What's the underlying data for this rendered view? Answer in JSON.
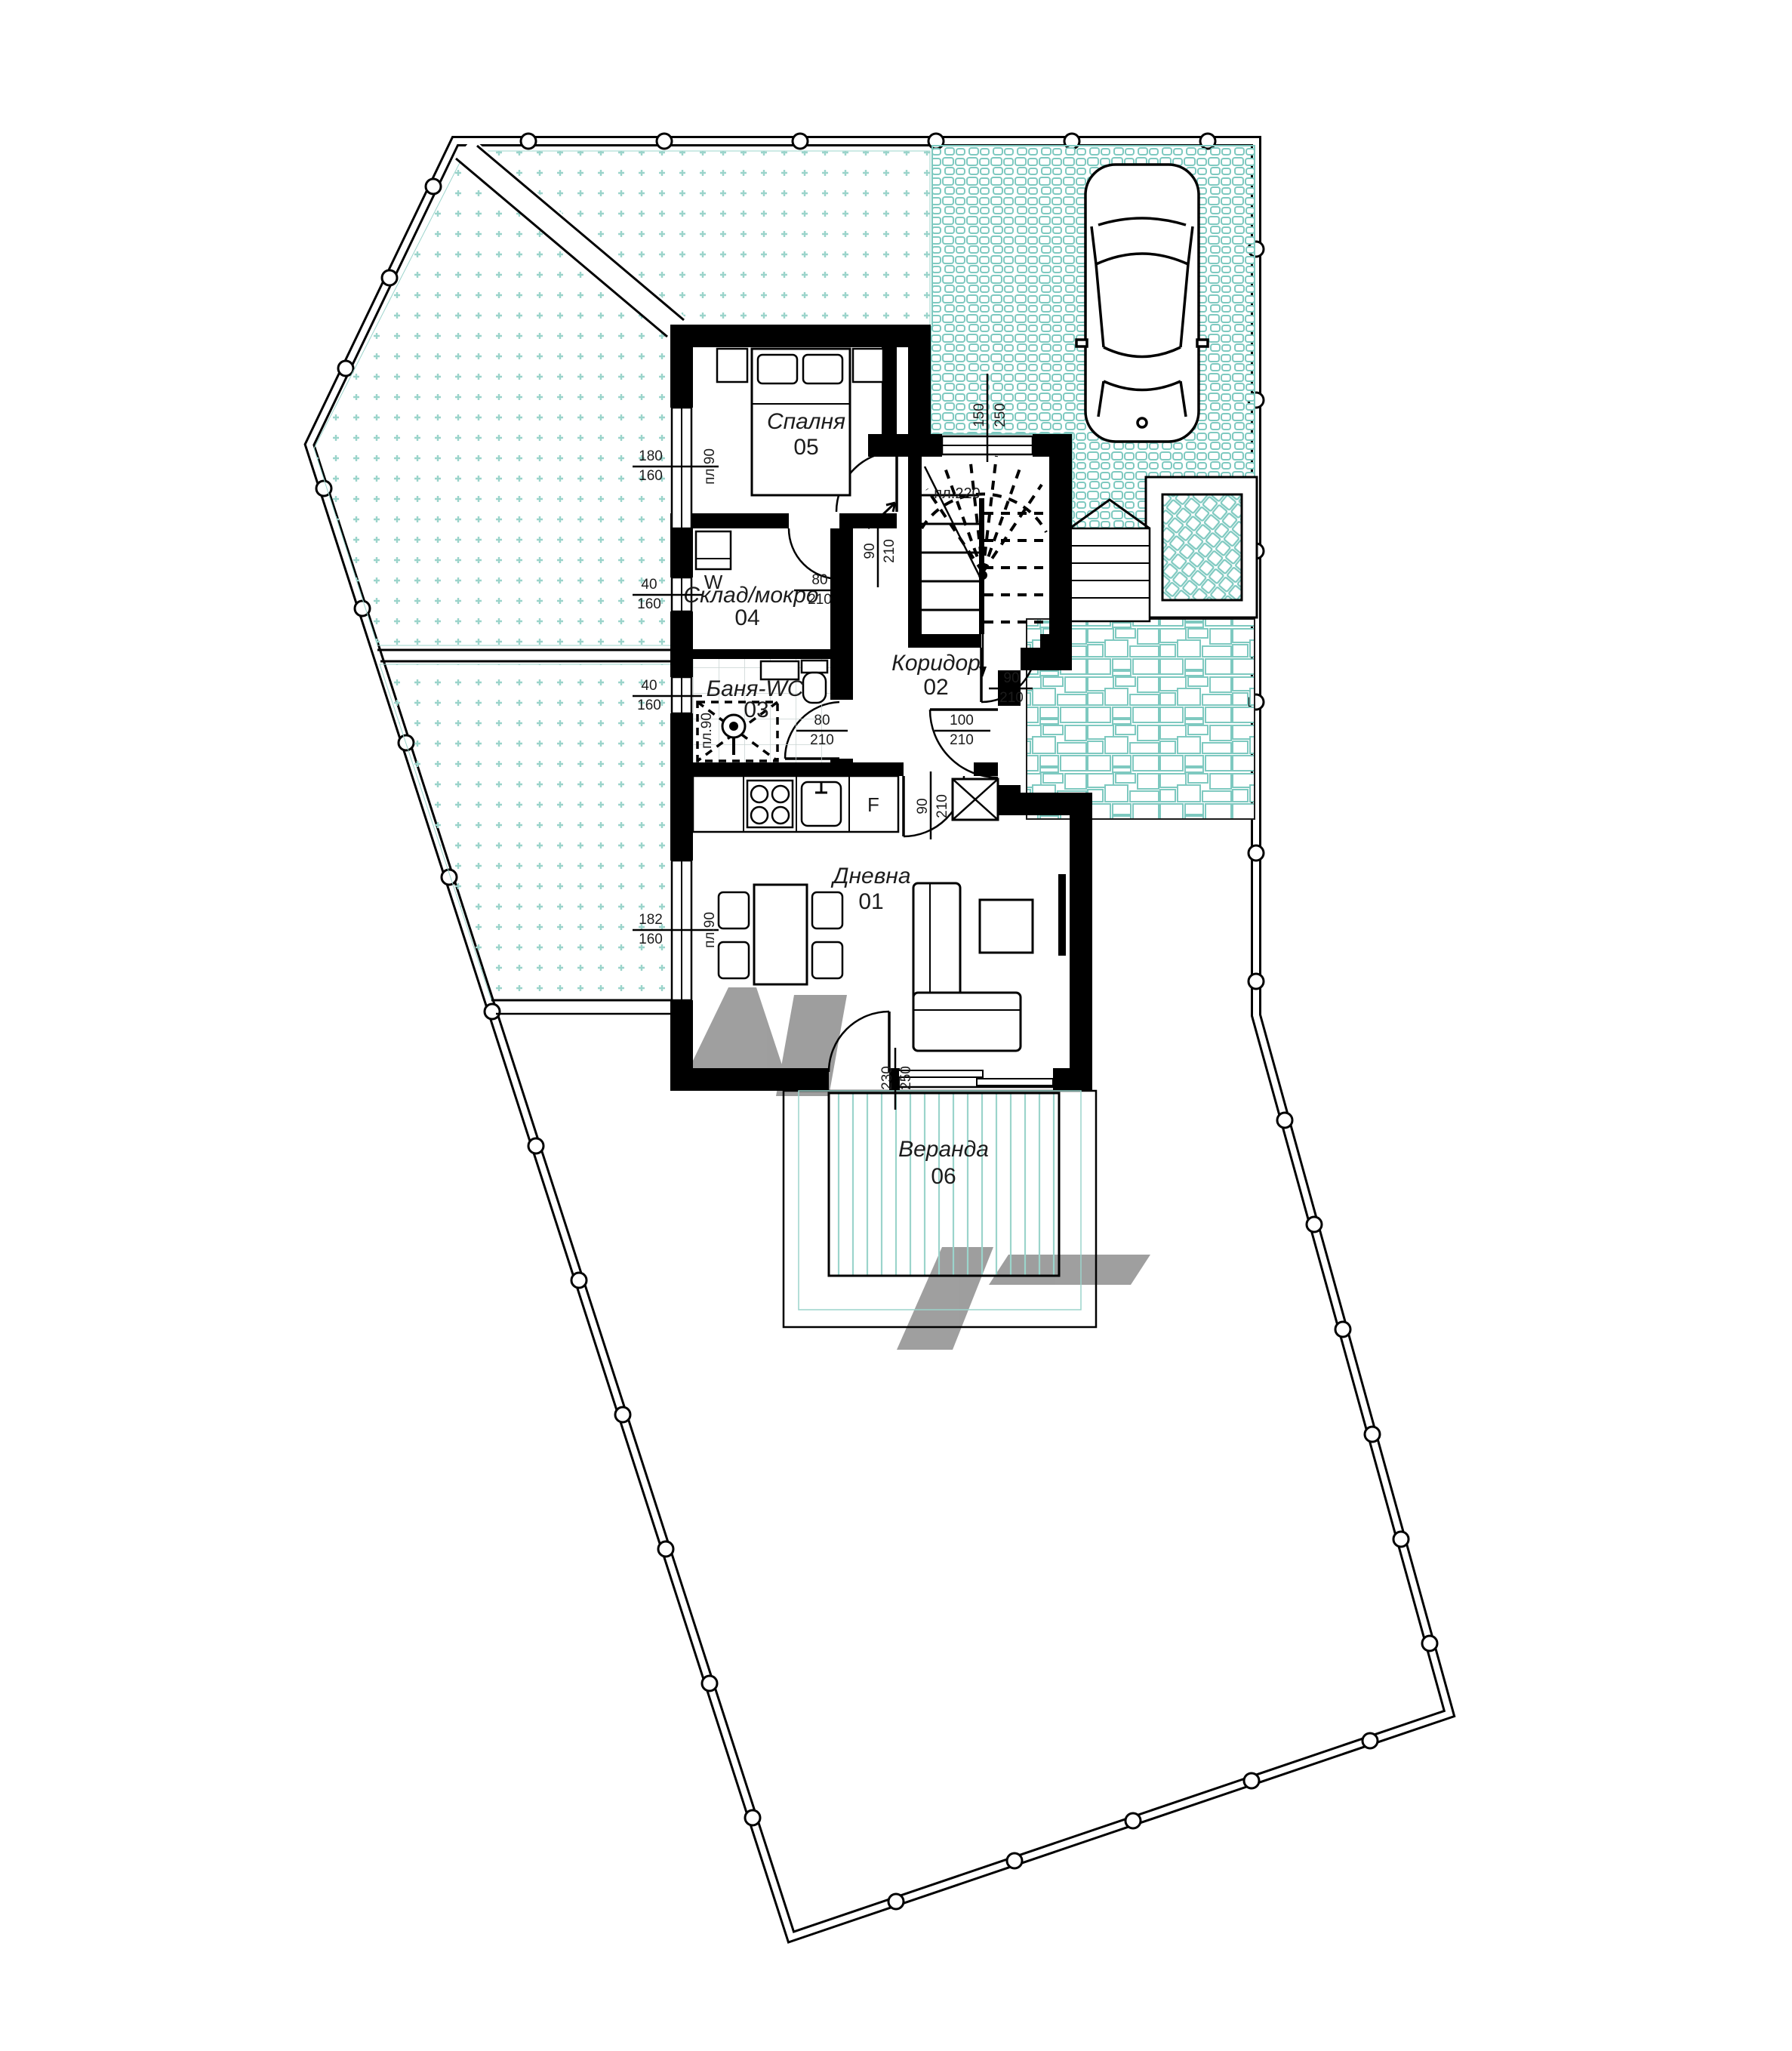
{
  "plan": {
    "type": "floor-plan",
    "language": "bg",
    "colors": {
      "paving_teal": "#7ec9c0",
      "dots_teal": "#9bd4cb",
      "deck_teal": "#9bd4cb",
      "wall_black": "#000000",
      "line_black": "#1c1c1c",
      "tile_gray": "#c9d4d2"
    }
  },
  "rooms": [
    {
      "name": "Спалня",
      "number": "05"
    },
    {
      "name": "Коридор",
      "number": "02"
    },
    {
      "name": "Баня-WC",
      "number": "03"
    },
    {
      "name": "Склад/мокро",
      "number": "04"
    },
    {
      "name": "Дневна",
      "number": "01"
    },
    {
      "name": "Веранда",
      "number": "06"
    }
  ],
  "stair": {
    "label": "пл.220"
  },
  "appliances": {
    "washing_machine": "W",
    "fridge": "F"
  },
  "dimensions": {
    "bedroom_window": {
      "w": "180",
      "h": "160",
      "sill": "пл.90"
    },
    "storage_window": {
      "w": "40",
      "h": "160"
    },
    "bath_window": {
      "w": "40",
      "h": "160"
    },
    "living_window": {
      "w": "182",
      "h": "160",
      "sill": "пл.90"
    },
    "stair_window": {
      "w": "150",
      "h": "250"
    },
    "bedroom_door": {
      "w": "90",
      "h": "210"
    },
    "storage_door": {
      "w": "80",
      "h": "210"
    },
    "bath_door": {
      "w": "80",
      "h": "210"
    },
    "living_door": {
      "w": "90",
      "h": "210"
    },
    "entrance_door": {
      "w": "100",
      "h": "210"
    },
    "stair_door": {
      "w": "90",
      "h": "210"
    },
    "veranda_door": {
      "w": "230",
      "h": "250"
    },
    "shower": {
      "label": "пл.90"
    }
  }
}
